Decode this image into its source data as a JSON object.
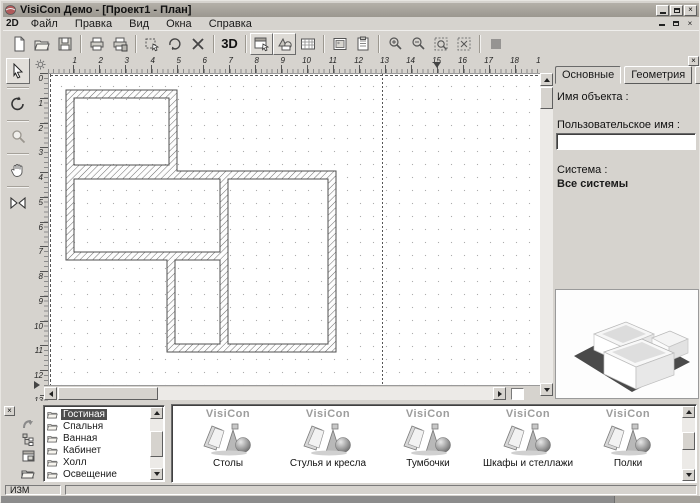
{
  "window": {
    "title": "VisiCon Демо - [Проект1 - План]"
  },
  "menu": {
    "prefix": "2D",
    "items": [
      {
        "label": "Файл"
      },
      {
        "label": "Правка"
      },
      {
        "label": "Вид"
      },
      {
        "label": "Окна"
      },
      {
        "label": "Справка"
      }
    ]
  },
  "toolbar": {
    "view3d_label": "3D"
  },
  "rulers": {
    "h": [
      {
        "n": "1"
      },
      {
        "n": "2"
      },
      {
        "n": "3"
      },
      {
        "n": "4"
      },
      {
        "n": "5"
      },
      {
        "n": "6"
      },
      {
        "n": "7"
      },
      {
        "n": "8"
      },
      {
        "n": "9"
      },
      {
        "n": "10"
      },
      {
        "n": "11"
      },
      {
        "n": "12"
      },
      {
        "n": "13"
      },
      {
        "n": "14"
      },
      {
        "n": "15"
      },
      {
        "n": "16"
      },
      {
        "n": "17"
      },
      {
        "n": "18"
      },
      {
        "n": "19"
      }
    ],
    "v": [
      {
        "n": "0"
      },
      {
        "n": "1"
      },
      {
        "n": "2"
      },
      {
        "n": "3"
      },
      {
        "n": "4"
      },
      {
        "n": "5"
      },
      {
        "n": "6"
      },
      {
        "n": "7"
      },
      {
        "n": "8"
      },
      {
        "n": "9"
      },
      {
        "n": "10"
      },
      {
        "n": "11"
      },
      {
        "n": "12"
      },
      {
        "n": "13"
      }
    ]
  },
  "right_panel": {
    "tabs": [
      {
        "label": "Основные",
        "active": true
      },
      {
        "label": "Геометрия",
        "active": false
      },
      {
        "label": "Материалы",
        "active": false
      }
    ],
    "object_name_label": "Имя объекта :",
    "user_name_label": "Пользовательское имя :",
    "user_name_value": "",
    "system_label": "Система :",
    "system_value": "Все системы"
  },
  "rooms": {
    "items": [
      {
        "label": "Гостиная",
        "selected": true
      },
      {
        "label": "Спальня",
        "selected": false
      },
      {
        "label": "Ванная",
        "selected": false
      },
      {
        "label": "Кабинет",
        "selected": false
      },
      {
        "label": "Холл",
        "selected": false
      },
      {
        "label": "Освещение",
        "selected": false
      }
    ]
  },
  "library": {
    "logo_text": "VisiCon",
    "items": [
      {
        "label": "Столы"
      },
      {
        "label": "Стулья и кресла"
      },
      {
        "label": "Тумбочки"
      },
      {
        "label": "Шкафы и стеллажи"
      },
      {
        "label": "Полки"
      }
    ]
  },
  "status": {
    "mode": "ИЗМ"
  },
  "icons": {
    "close_glyph": "×"
  },
  "colors": {
    "chrome": "#d6d3ce",
    "titlebar": "#a8a49d",
    "canvas": "#ffffff",
    "wall_stroke": "#5a5a5a",
    "selection": "#4d4d4d"
  }
}
